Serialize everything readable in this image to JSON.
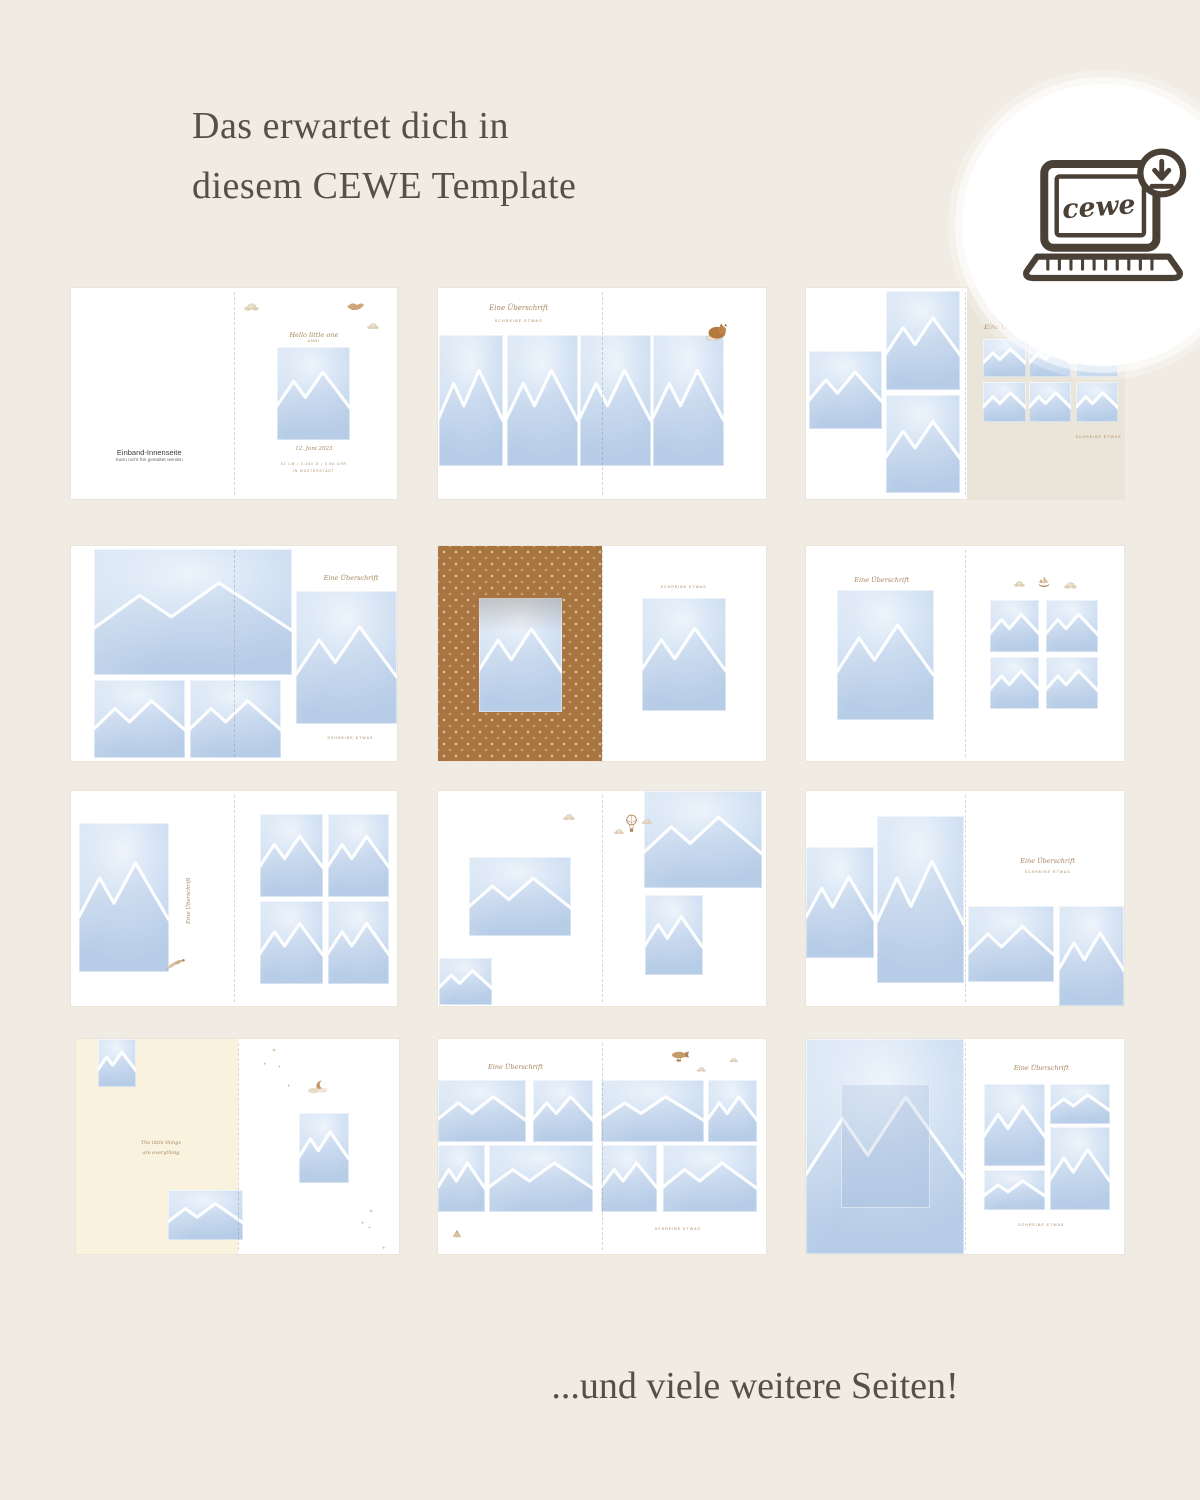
{
  "page": {
    "background": "#f1ece3",
    "title_line1": "Das erwartet dich in",
    "title_line2": "diesem CEWE Template",
    "footer": "...und viele weitere Seiten!"
  },
  "badge": {
    "logo": "cewe"
  },
  "labels": {
    "heading_script": "Eine Überschrift",
    "heading_sub": "Schreibe etwas"
  },
  "cover": {
    "title": "Einband-Innenseite",
    "subtitle": "Kann nicht frei gestaltet werden",
    "greeting": "Hello little one",
    "name": "Anni",
    "date": "12. Juni 2023",
    "stats": "52 cm | 3.450 g | 4:56 Uhr",
    "place": "in Musterstadt"
  },
  "quote": {
    "line1": "The little things",
    "line2": "are everything"
  },
  "colors": {
    "accent_brown": "#a8875f",
    "icon_brown": "#4a4036",
    "placeholder_blue": "#cfe0f2",
    "pattern_brown": "#a87440",
    "cream_page": "#f9f2df",
    "beige_page": "#ebe5d9"
  }
}
